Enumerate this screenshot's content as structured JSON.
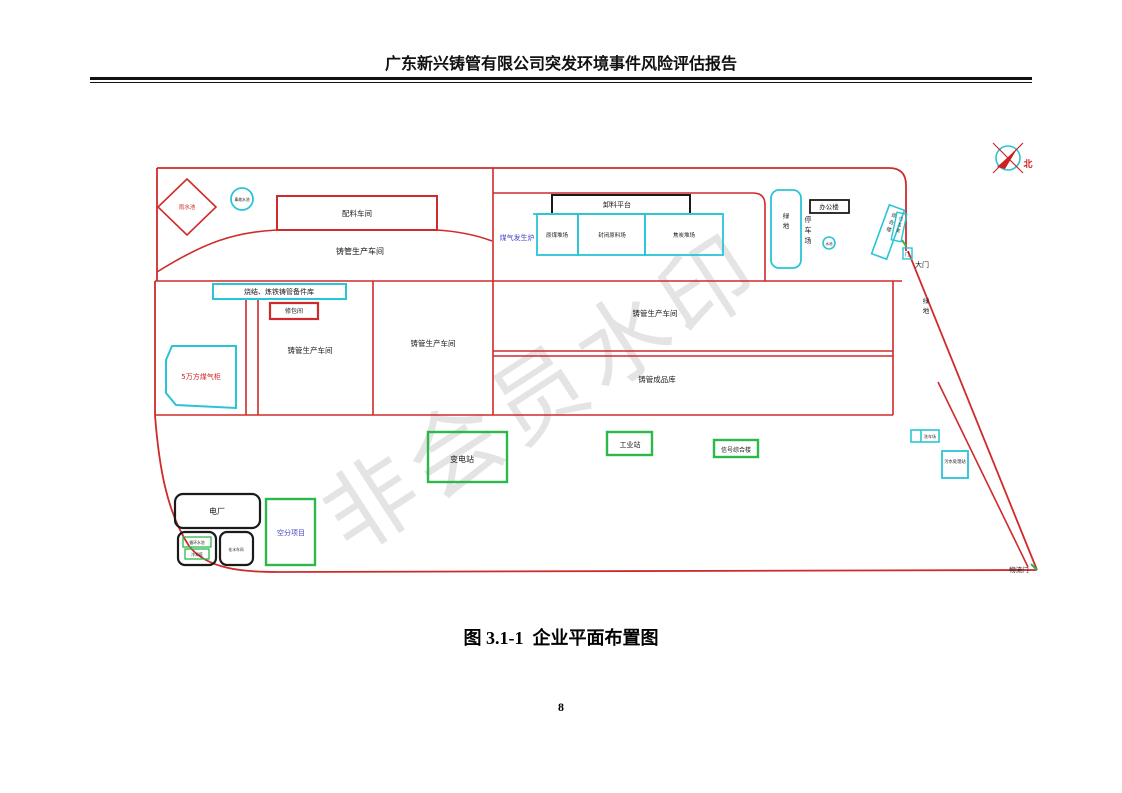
{
  "header": {
    "title": "广东新兴铸管有限公司突发环境事件风险评估报告"
  },
  "watermark": "非会员水印",
  "figure": {
    "compass_north": "北",
    "top_block": {
      "rainwater_pool": "雨水池",
      "accident_pool": "事故水池",
      "batching_workshop": "配料车间",
      "pipe_workshop": "铸管生产车间",
      "gas_generator": "煤气发生炉",
      "unloading_platform": "卸料平台",
      "raw_coal_yard": "原煤堆场",
      "enclosed_material_yard": "封闭原料场",
      "coke_yard": "焦炭堆场",
      "green_space": "绿地",
      "office_building": "办公楼",
      "parking_lot": "停车场",
      "pool_small": "水池",
      "complex_building": "综合楼",
      "guard_room": "门卫室",
      "gate_mark": "门",
      "main_gate": "大门",
      "roadside_green": "绿地"
    },
    "middle_block": {
      "spare_parts_warehouse": "烧结、炼铁铸管备件库",
      "repair_room": "修包间",
      "pipe_workshop_west": "铸管生产车间",
      "pipe_workshop_mid": "铸管生产车间",
      "gas_holder": "5万方煤气柜",
      "pipe_workshop_east": "铸管生产车间",
      "finished_pipe_warehouse": "铸管成品库"
    },
    "bottom_block": {
      "substation": "变电站",
      "industrial_station": "工业站",
      "signal_building": "信号综合楼",
      "power_plant": "电厂",
      "circulating_pool": "循环水池",
      "cooling_tower": "冷却塔",
      "water_treatment": "化水车间",
      "air_separation": "空分项目",
      "car_wash": "洗车场",
      "sewage_station": "污水处理站",
      "logistics_gate": "物流门"
    }
  },
  "caption": "图 3.1-1  企业平面布置图",
  "page_number": "8",
  "colors": {
    "boundary_red": "#cf2b2b",
    "facility_cyan": "#29c5d6",
    "facility_green": "#2db84b",
    "label_blue": "#4646c8",
    "label_red": "#d02020"
  }
}
